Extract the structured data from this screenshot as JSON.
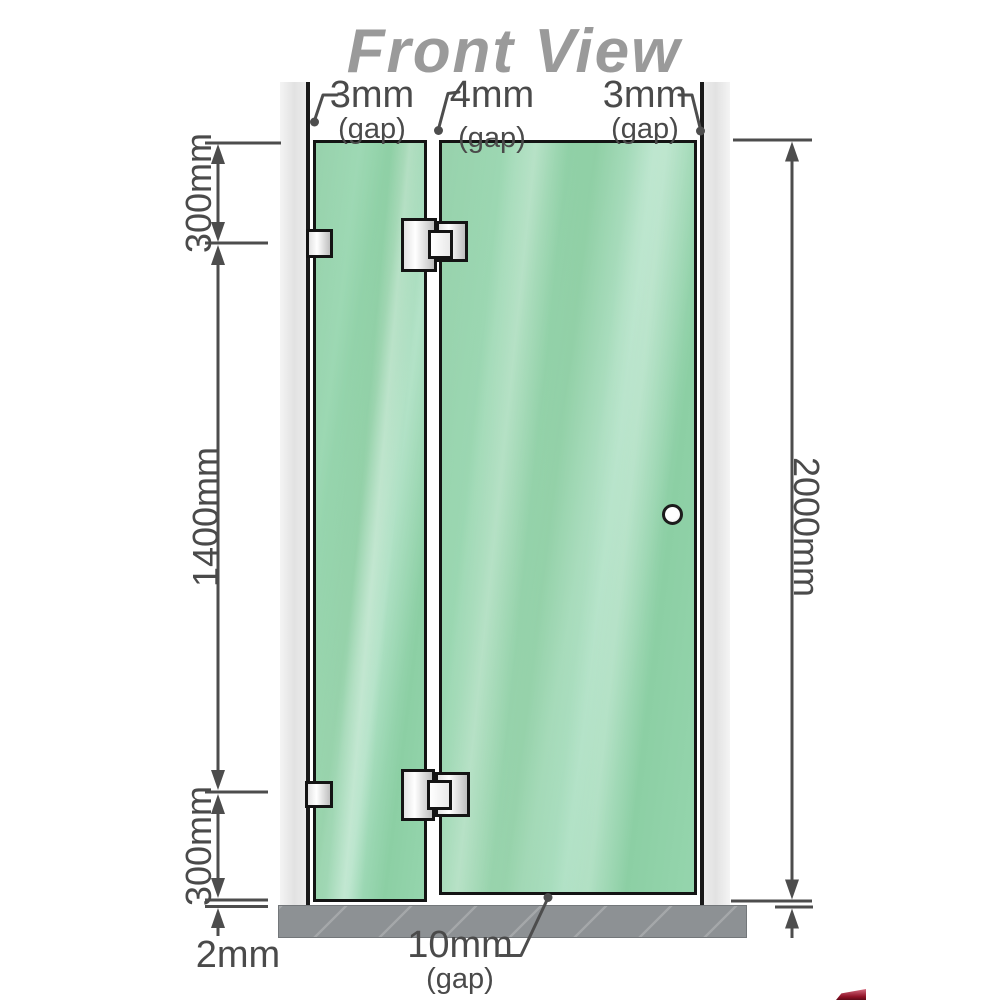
{
  "title": "Front View",
  "annotations": {
    "top_gap_left": {
      "value": "3mm",
      "note": "(gap)"
    },
    "top_gap_middle": {
      "value": "4mm",
      "note": "(gap)"
    },
    "top_gap_right": {
      "value": "3mm",
      "note": "(gap)"
    },
    "bottom_gap": {
      "value": "10mm",
      "note": "(gap)"
    },
    "left_top_segment": "300mm",
    "left_middle_segment": "1400mm",
    "left_bottom_segment": "300mm",
    "floor_gap": "2mm",
    "right_total_height": "2000mm"
  },
  "colors": {
    "glass": "#8fd0a7",
    "wall_channel": "#e9e9e9",
    "floor": "#8d9194",
    "outline": "#141414",
    "dimension_lines": "#4d4d4d",
    "title_text": "#9a9a9a"
  }
}
